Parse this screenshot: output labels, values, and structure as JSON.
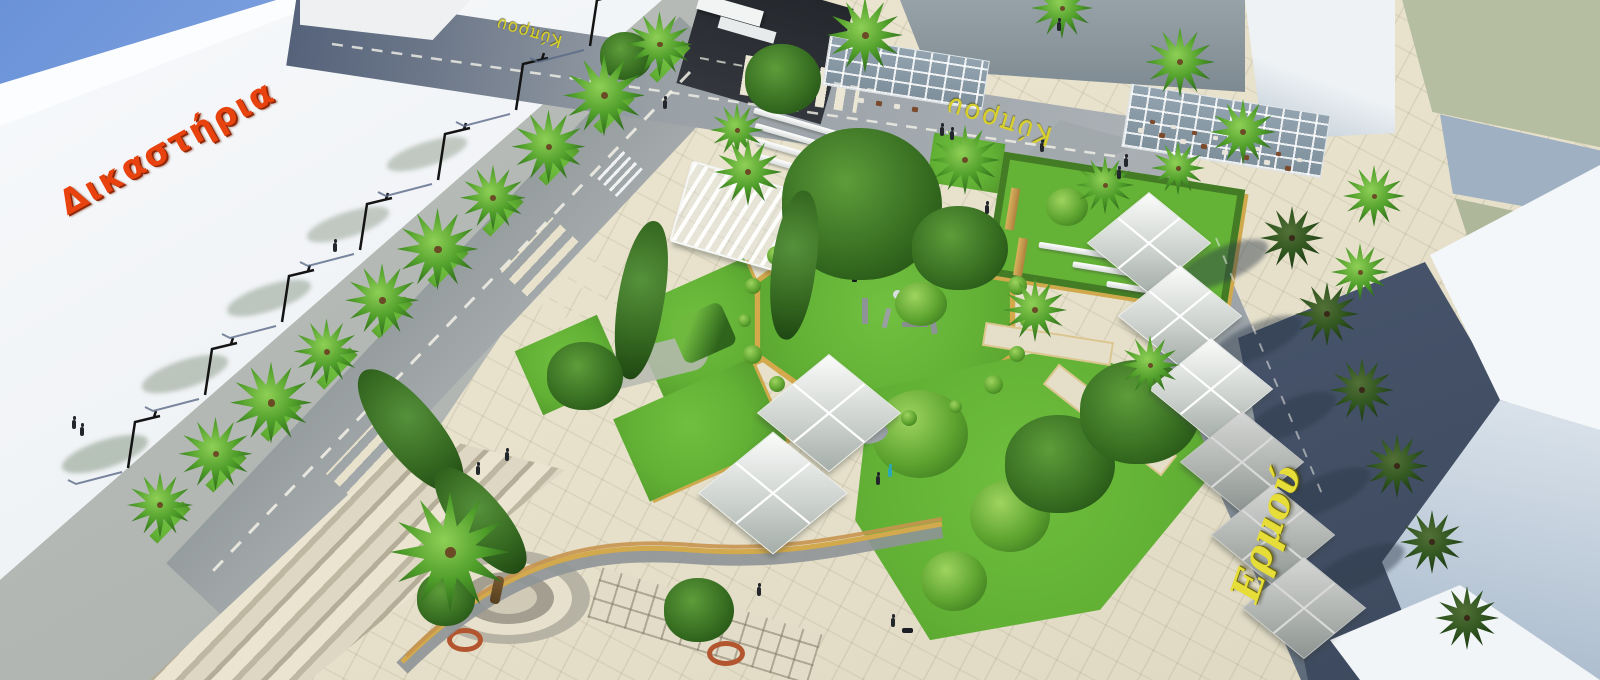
{
  "meta": {
    "description": "Aerial 3D architectural rendering of a redesigned town square with palm-lined streets, lawns, pergolas and tensile canopies",
    "view": "aerial perspective render"
  },
  "labels": {
    "courthouse_sign": "Δικαστήρια",
    "street_top": "Κύπρου",
    "street_top_right": "Κύπρου",
    "street_right": "Ερμού"
  },
  "colors": {
    "sky": "#6e95d9",
    "courthouse_sign_red": "#e8430f",
    "street_label_yellow": "#ddd42a",
    "lawn_green": "#65b437",
    "plaza_paving": "#e7e1cb",
    "road_gray": "#9aa1a5",
    "edging_tan": "#d3a94c",
    "canopy_white": "#f4f6f5",
    "sage_roof": "#b6bea2"
  }
}
